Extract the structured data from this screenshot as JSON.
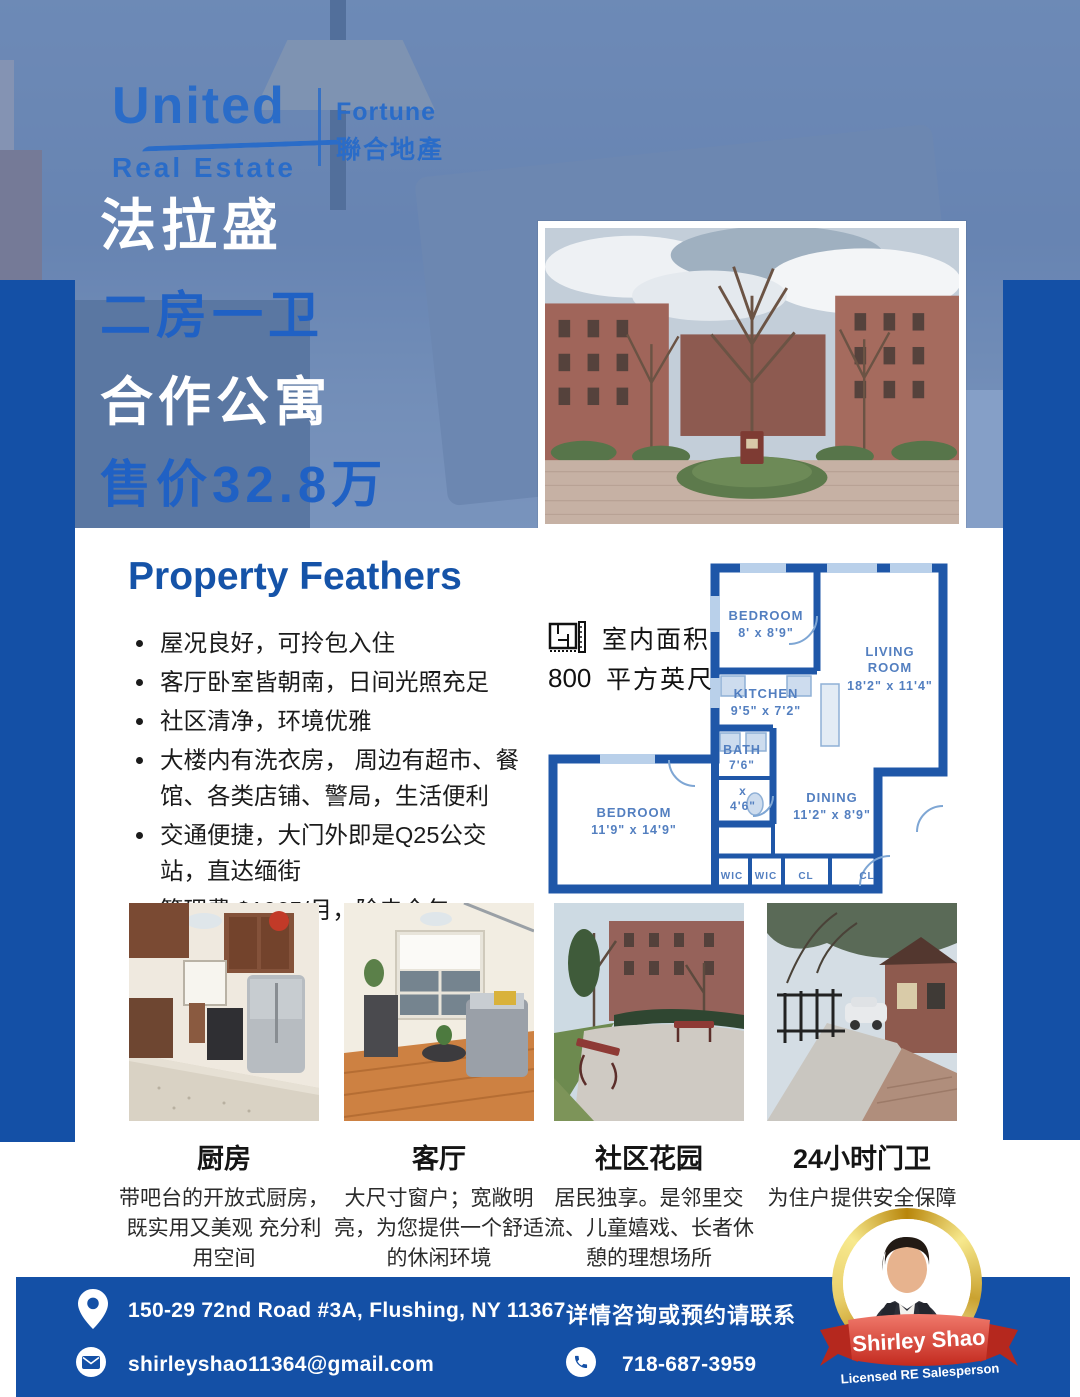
{
  "brand": {
    "united": "United",
    "real_estate": "Real Estate",
    "fortune_en": "Fortune",
    "fortune_cn": "聯合地產"
  },
  "headline": {
    "line1": "法拉盛",
    "line2": "二房一卫",
    "line3": "合作公寓",
    "line4": "售价32.8万"
  },
  "features": {
    "title": "Property Feathers",
    "items": [
      "屋况良好，可拎包入住",
      "客厅卧室皆朝南，日间光照充足",
      "社区清净，环境优雅",
      "大楼内有洗衣房， 周边有超市、餐馆、各类店铺、警局，生活便利",
      "交通便捷，大门外即是Q25公交站，直达缅街",
      "管理费 $1065/月，除电全包"
    ]
  },
  "floorplan": {
    "area_label": "室内面积",
    "area_value": "800",
    "area_unit": "平方英尺",
    "rooms": {
      "bedroom_top_name": "BEDROOM",
      "bedroom_top_size": "8' x 8'9\"",
      "living_name1": "LIVING",
      "living_name2": "ROOM",
      "living_size": "18'2\" x 11'4\"",
      "kitchen_name": "KITCHEN",
      "kitchen_size": "9'5\" x 7'2\"",
      "bath_name": "BATH",
      "bath_size1": "7'6\"",
      "bath_x": "x",
      "bath_size2": "4'6\"",
      "dining_name": "DINING",
      "dining_size": "11'2\" x 8'9\"",
      "bedroom_main_name": "BEDROOM",
      "bedroom_main_size": "11'9\" x 14'9\"",
      "wic1": "WIC",
      "wic2": "WIC",
      "cl1": "CL",
      "cl2": "CL"
    }
  },
  "gallery": [
    {
      "title": "厨房",
      "desc": "带吧台的开放式厨房，既实用又美观 充分利用空间"
    },
    {
      "title": "客厅",
      "desc": "大尺寸窗户；宽敞明亮，为您提供一个舒适的休闲环境"
    },
    {
      "title": "社区花园",
      "desc": "居民独享。是邻里交流、儿童嬉戏、长者休憩的理想场所"
    },
    {
      "title": "24小时门卫",
      "desc": "为住户提供安全保障"
    }
  ],
  "footer": {
    "address": "150-29 72nd Road #3A, Flushing, NY 11367",
    "contact_cta": "详情咨询或预约请联系",
    "email": "shirleyshao11364@gmail.com",
    "phone": "718-687-3959"
  },
  "agent": {
    "name": "Shirley Shao",
    "title": "Licensed RE Salesperson"
  },
  "icons": {
    "location": "location-pin-icon",
    "email": "envelope-icon",
    "phone": "phone-icon",
    "area": "ruler-floorplan-icon"
  },
  "colors": {
    "primary_blue": "#1450a6",
    "headline_blue": "#2061c4",
    "logo_blue": "#2a6cc8",
    "floorplan_wall_blue": "#1f57a8",
    "ribbon_red": "#cf2e24",
    "gold": "#d4af37",
    "hero_overlay": "rgba(43,88,161,0.52)"
  }
}
